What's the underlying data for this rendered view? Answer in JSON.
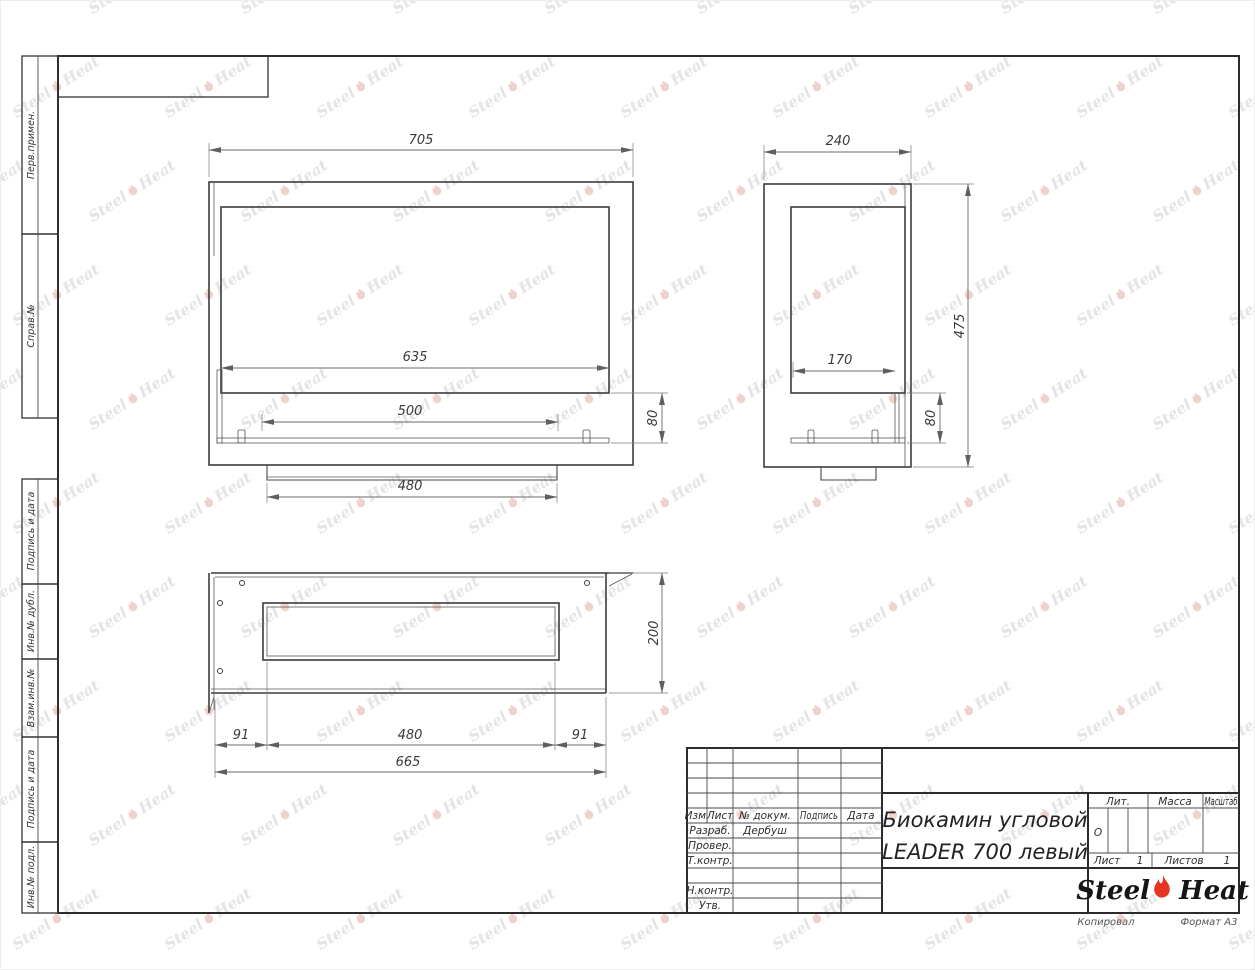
{
  "document": {
    "title_line1": "Биокамин угловой",
    "title_line2": "LEADER 700 левый",
    "format": "Формат А3",
    "copied_label": "Копировал"
  },
  "title_block": {
    "change_header": [
      "Изм.",
      "Лист",
      "№ докум.",
      "Подпись",
      "Дата"
    ],
    "sign_rows": [
      {
        "label": "Разраб.",
        "value": "Дербуш"
      },
      {
        "label": "Провер.",
        "value": ""
      },
      {
        "label": "Т.контр.",
        "value": ""
      },
      {
        "label": "Н.контр.",
        "value": ""
      },
      {
        "label": "Утв.",
        "value": ""
      }
    ],
    "lit_label": "Лит.",
    "lit_value": "О",
    "mass_label": "Масса",
    "scale_label": "Масштаб",
    "sheet_label": "Лист",
    "sheet_number": "1",
    "sheets_label": "Листов",
    "sheets_total": "1"
  },
  "logo": {
    "steel": "Steel",
    "heat": "Heat",
    "flame_color": "#e63322"
  },
  "margin": [
    {
      "label": "Перв.примен."
    },
    {
      "label": "Справ.№"
    },
    {
      "label": "Подпись и дата"
    },
    {
      "label": "Инв.№ дубл."
    },
    {
      "label": "Взам.инв.№"
    },
    {
      "label": "Подпись и дата"
    },
    {
      "label": "Инв.№ подл."
    }
  ],
  "dims": {
    "front": {
      "w": "705",
      "opening": "635",
      "burner": "500",
      "tray": "80",
      "base": "480"
    },
    "side": {
      "d": "240",
      "inner": "170",
      "h": "475",
      "tray": "80"
    },
    "top": {
      "h": "200",
      "left_offset": "91",
      "opening": "480",
      "right_offset": "91",
      "total": "665"
    }
  },
  "watermark": {
    "steel": "Steel",
    "heat": "Heat",
    "text_color": "#e4e4e4",
    "flame_tint": "#eed2cb"
  }
}
